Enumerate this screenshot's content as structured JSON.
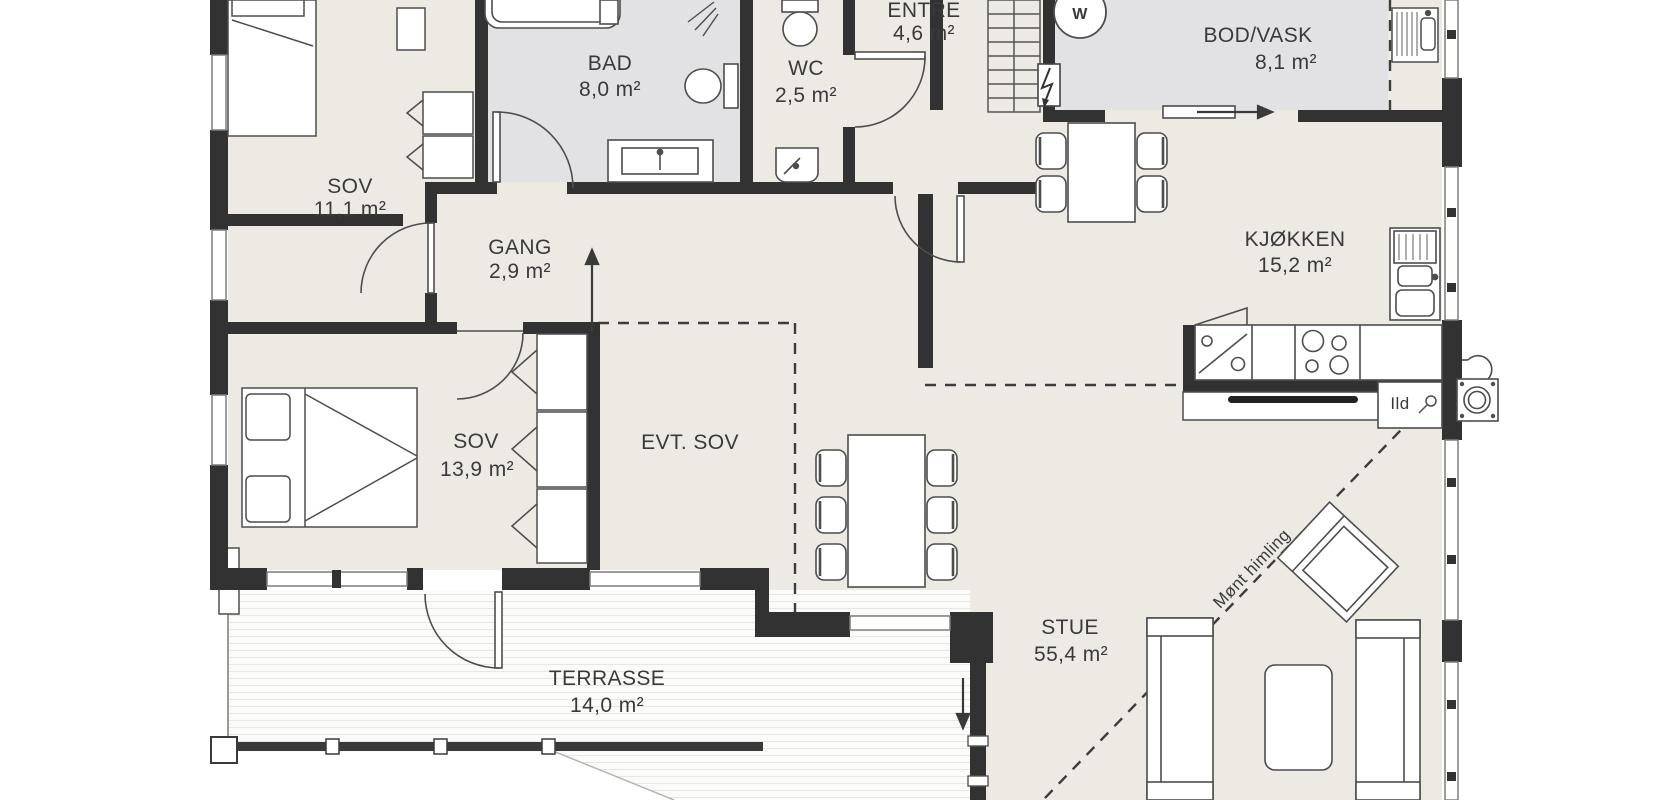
{
  "plan_title": "Floor plan",
  "rooms": [
    {
      "name": "SOV",
      "area": "11,1 m²"
    },
    {
      "name": "BAD",
      "area": "8,0 m²"
    },
    {
      "name": "WC",
      "area": "2,5 m²"
    },
    {
      "name": "ENTRE",
      "area": "4,6 m²"
    },
    {
      "name": "BOD/VASK",
      "area": "8,1 m²"
    },
    {
      "name": "GANG",
      "area": "2,9 m²"
    },
    {
      "name": "KJØKKEN",
      "area": "15,2 m²"
    },
    {
      "name": "SOV",
      "area": "13,9 m²"
    },
    {
      "name": "EVT. SOV",
      "area": ""
    },
    {
      "name": "STUE",
      "area": "55,4 m²"
    },
    {
      "name": "TERRASSE",
      "area": "14,0 m²"
    }
  ],
  "annotations": {
    "fireplace_label": "Ild",
    "ceiling_label": "Mønt himling",
    "washer_label": "W"
  },
  "colors": {
    "wall": "#323232",
    "wet_room_floor": "#e2e2e4",
    "floor": "#edeae4",
    "outline": "#4d4d4d",
    "deck_line": "#e7e7e3"
  }
}
